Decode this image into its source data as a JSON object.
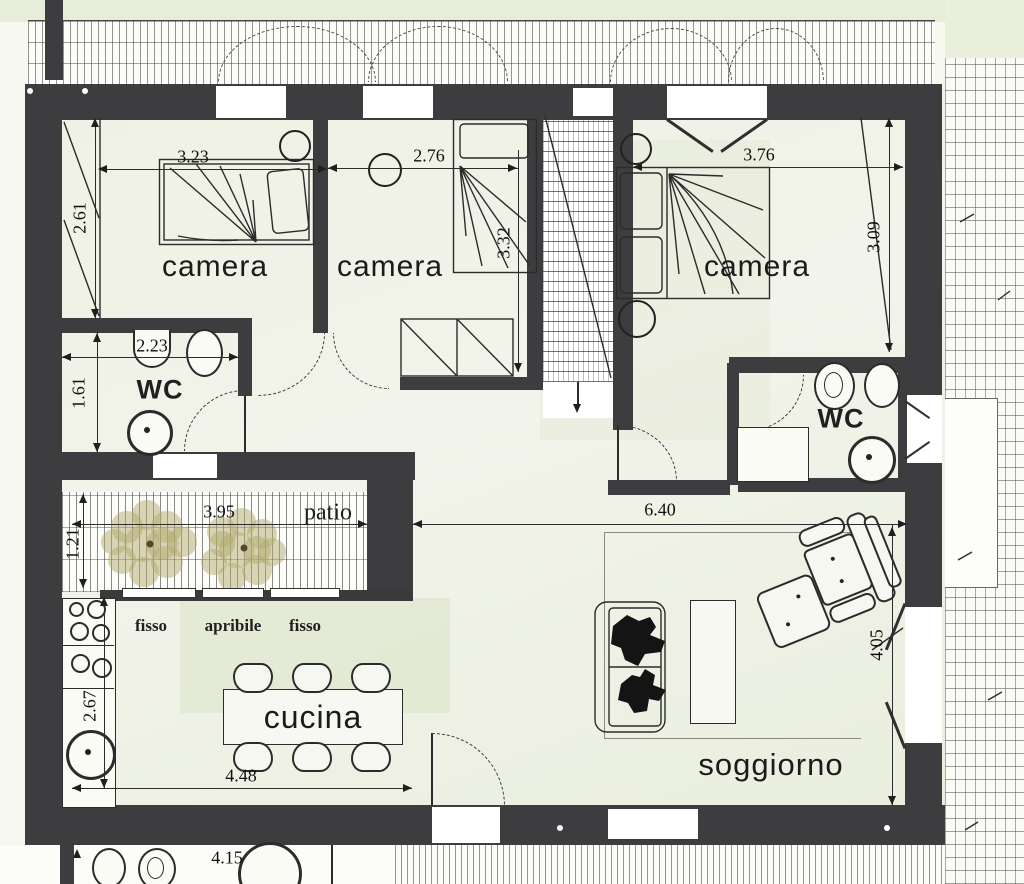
{
  "plan_type": "apartment-floor-plan",
  "rooms": {
    "camera1": {
      "label": "camera",
      "width_m": "3.23",
      "height_m": "2.61"
    },
    "camera2": {
      "label": "camera",
      "width_m": "2.76",
      "height_m": "3.32"
    },
    "camera3": {
      "label": "camera",
      "width_m": "3.76",
      "height_m": "3.09"
    },
    "wc1": {
      "label": "WC",
      "width_m": "2.23",
      "height_m": "1.61"
    },
    "wc2": {
      "label": "WC"
    },
    "patio": {
      "label": "patio",
      "width_m": "3.95",
      "depth_m": "1.21"
    },
    "cucina": {
      "label": "cucina",
      "width_m": "4.48",
      "height_m": "2.67"
    },
    "soggiorno": {
      "label": "soggiorno",
      "width_m": "6.40",
      "height_m": "4.05"
    },
    "lower_level": {
      "width_m": "4.15"
    }
  },
  "window_labels": [
    "fisso",
    "apribile",
    "fisso"
  ],
  "icons": {
    "stair_direction": "down-arrow"
  },
  "colors": {
    "wall": "#3d3d3f",
    "paper": "#f0f2e5",
    "ink": "#1f1f1f",
    "tree": "#b2a96e"
  }
}
